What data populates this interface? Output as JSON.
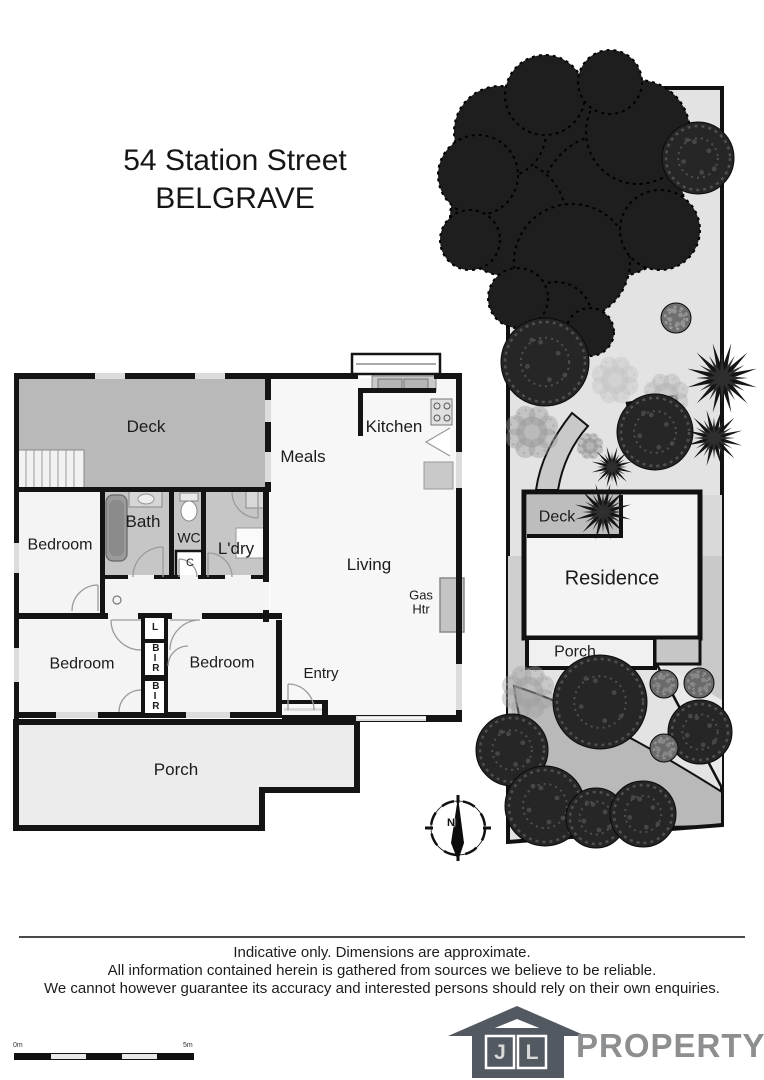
{
  "title": {
    "line1": "54 Station Street",
    "line2": "BELGRAVE"
  },
  "floor_plan": {
    "labels": {
      "deck": "Deck",
      "meals": "Meals",
      "kitchen": "Kitchen",
      "bedroom_left": "Bedroom",
      "bath": "Bath",
      "wc": "WC",
      "laundry": "L'dry",
      "cupboard": "C",
      "living": "Living",
      "gas_heater": "Gas\nHtr",
      "bedroom_sw": "Bedroom",
      "bedroom_s": "Bedroom",
      "entry": "Entry",
      "porch": "Porch",
      "linen": "L",
      "robe_top": "BIR",
      "robe_bottom": "BIR"
    },
    "compass_north": "N"
  },
  "site_plan": {
    "labels": {
      "deck": "Deck",
      "residence": "Residence",
      "porch": "Porch"
    }
  },
  "disclaimer": {
    "line1": "Indicative only. Dimensions are approximate.",
    "line2": "All information contained herein is gathered from sources we believe to be reliable.",
    "line3": "We cannot however guarantee its accuracy and interested persons should rely on their own enquiries."
  },
  "scale_bar": {
    "start_label": "0m",
    "end_label": "5m"
  },
  "logo": {
    "window_j": "J",
    "window_l": "L",
    "brand": "PROPERTY"
  },
  "colors": {
    "wall": "#141414",
    "deck_fill": "#b9b9b9",
    "wet_floor": "#c6c6c6",
    "porch_fill": "#ececec",
    "site_ground": "#e3e3e3",
    "driveway": "#b9b9b9",
    "tree_dark": "#1e1e1e",
    "logo_house": "#535960",
    "logo_text": "#8c8e90"
  }
}
